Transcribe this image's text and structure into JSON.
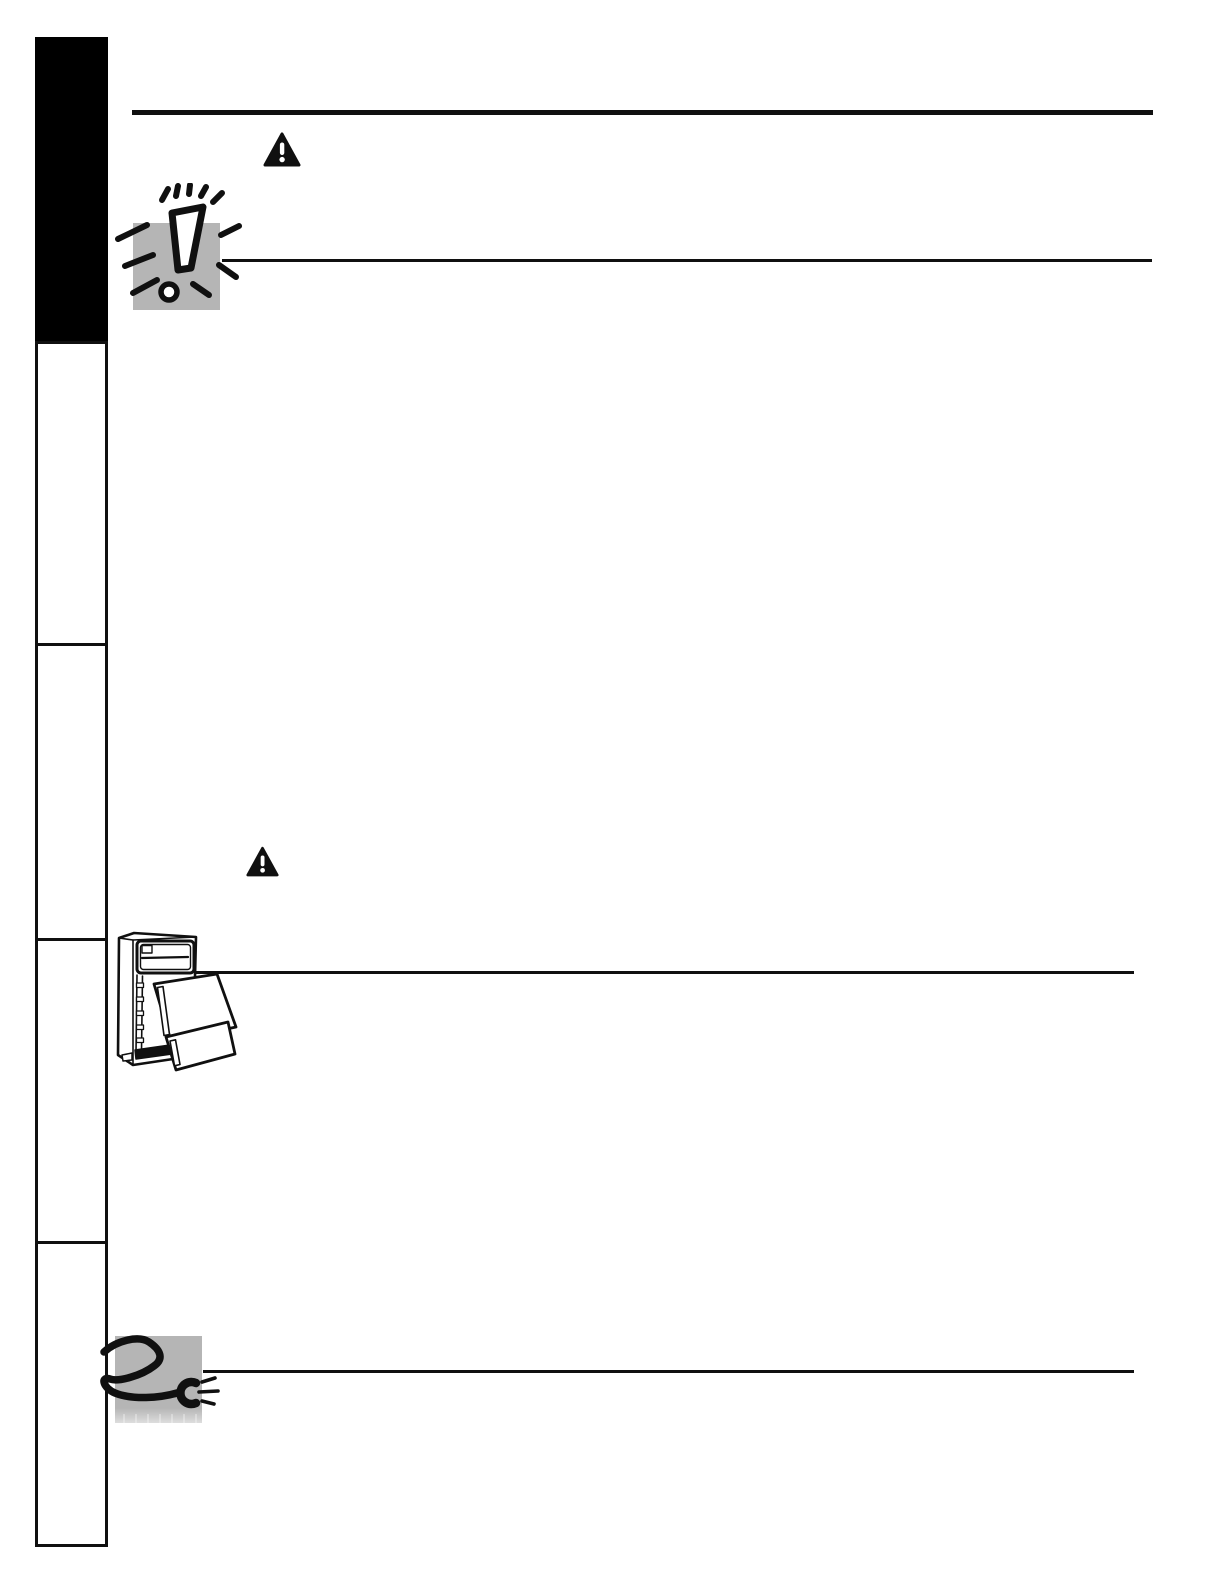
{
  "document": {
    "kind": "scanned manual page, graphics only (no visible text)",
    "page_background": "#ffffff"
  },
  "colors": {
    "page_bg": "#ffffff",
    "ink": "#101010",
    "tab_black": "#000000",
    "panel_gray": "#b5b5b5",
    "panel_fade": "#d8d8d8"
  },
  "sidebar": {
    "tabs": [
      {
        "name": "section-tab-1",
        "style": "filled-black",
        "active": true
      },
      {
        "name": "section-tab-2",
        "style": "outline",
        "active": false
      },
      {
        "name": "section-tab-3",
        "style": "outline",
        "active": false
      },
      {
        "name": "section-tab-4",
        "style": "outline",
        "active": false
      },
      {
        "name": "section-tab-5",
        "style": "outline",
        "active": false
      }
    ]
  },
  "icons": {
    "warning_top": {
      "label": "warning-triangle-icon",
      "glyph": "filled triangle with white exclamation"
    },
    "warning_mid": {
      "label": "warning-triangle-icon",
      "glyph": "filled triangle with white exclamation"
    },
    "exclamation_burst": {
      "label": "exclamation-burst-clipart",
      "glyph": "hand-drawn exclamation mark with radiating dashes on gray square"
    },
    "refrigerator": {
      "label": "refrigerator-doors-removed-illustration",
      "glyph": "top-freezer refrigerator with both doors taken off and leaning against cabinet"
    },
    "power_cord": {
      "label": "power-cord-plug-clipart",
      "glyph": "coiled power cord with plug on gray square"
    }
  }
}
